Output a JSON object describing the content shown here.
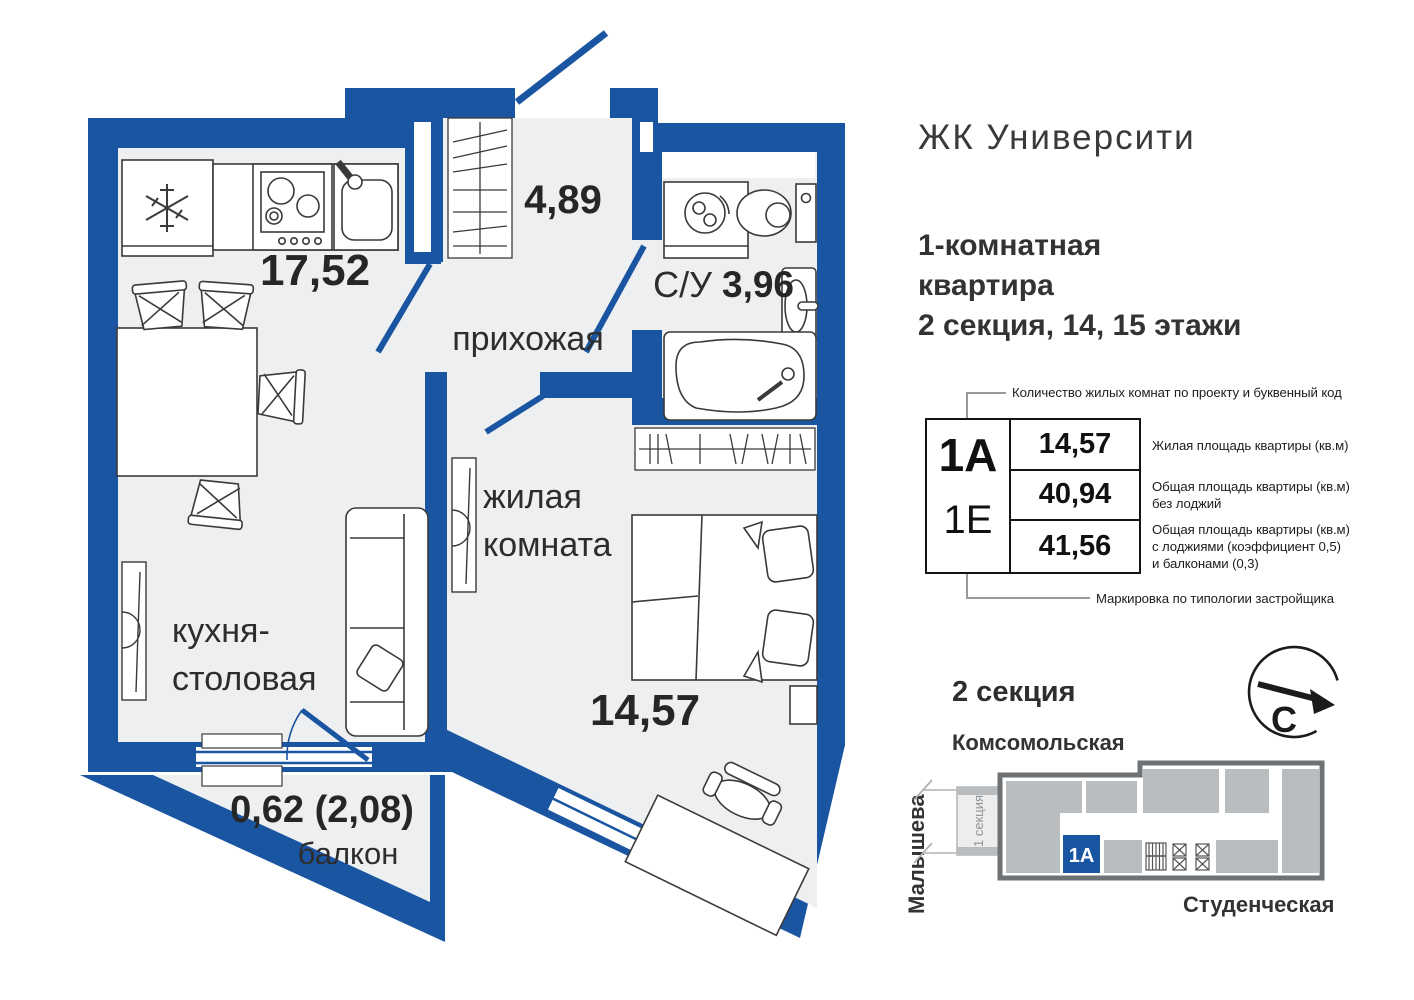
{
  "header": {
    "complex_name": "ЖК Университи",
    "subtitle_line1": "1-комнатная",
    "subtitle_line2": "квартира",
    "subtitle_line3": "2 секция, 14, 15 этажи"
  },
  "floorplan": {
    "kitchen_area": "17,52",
    "kitchen_label_line1": "кухня-",
    "kitchen_label_line2": "столовая",
    "hall_area": "4,89",
    "hall_label": "прихожая",
    "bath_label": "С/У",
    "bath_area": "3,96",
    "living_label_line1": "жилая",
    "living_label_line2": "комната",
    "living_area": "14,57",
    "balcony_area": "0,62 (2,08)",
    "balcony_label": "балкон"
  },
  "legend": {
    "type_code": "1А",
    "developer_code": "1Е",
    "living_area": "14,57",
    "total_area": "40,94",
    "total_area_with_summer": "41,56",
    "note_top": "Количество жилых комнат по проекту и буквенный код",
    "note_row1": "Жилая площадь квартиры (кв.м)",
    "note_row2_line1": "Общая площадь квартиры (кв.м)",
    "note_row2_line2": "без лоджий",
    "note_row3_line1": "Общая площадь квартиры (кв.м)",
    "note_row3_line2": "с лоджиями (коэффициент 0,5)",
    "note_row3_line3": "и балконами (0,3)",
    "note_bottom": "Маркировка по типологии застройщика"
  },
  "sitemap": {
    "title": "2 секция",
    "north_label": "С",
    "street_top": "Комсомольская",
    "street_left": "Малышева",
    "street_bottom": "Студенческая",
    "highlighted_unit": "1А",
    "neighbor_section": "1 секция"
  },
  "colors": {
    "wall_blue": "#1a55a2",
    "floor_gray": "#edeff0",
    "sitemap_gray": "#b9bdc0"
  }
}
